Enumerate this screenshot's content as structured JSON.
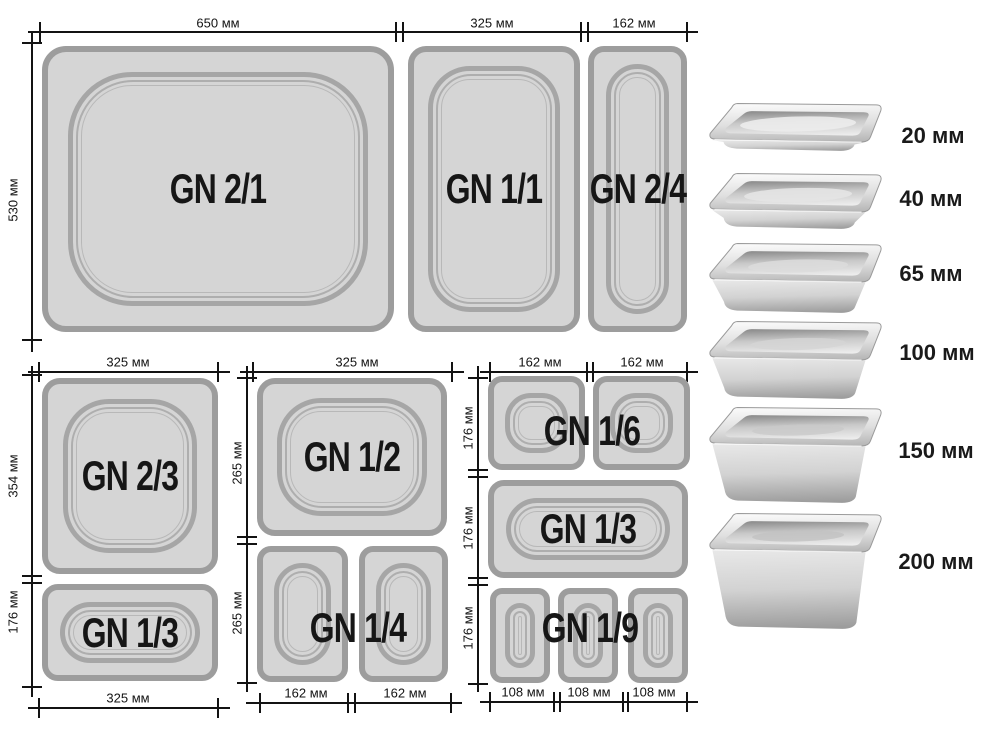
{
  "diagram": {
    "pans": {
      "gn21": "GN 2/1",
      "gn11": "GN 1/1",
      "gn24": "GN 2/4",
      "gn23": "GN 2/3",
      "gn13_left": "GN 1/3",
      "gn12": "GN 1/2",
      "gn14": "GN 1/4",
      "gn16": "GN 1/6",
      "gn13_right": "GN 1/3",
      "gn19": "GN 1/9"
    },
    "dims": {
      "d650": "650 мм",
      "d325_top": "325 мм",
      "d162_top": "162 мм",
      "d530": "530 мм",
      "bl_325_top": "325 мм",
      "bl_354": "354 мм",
      "bl_176": "176 мм",
      "bl_325_bottom": "325 мм",
      "mid_325_top": "325 мм",
      "mid_265_upper": "265 мм",
      "mid_265_lower": "265 мм",
      "mid_162_left": "162 мм",
      "mid_162_right": "162 мм",
      "r_162_left": "162 мм",
      "r_162_right": "162 мм",
      "r_176_upper": "176 мм",
      "r_176_middle": "176 мм",
      "r_176_lower": "176 мм",
      "r_108_left": "108 мм",
      "r_108_center": "108 мм",
      "r_108_right": "108 мм"
    },
    "depths": {
      "d20": "20 мм",
      "d40": "40 мм",
      "d65": "65 мм",
      "d100": "100 мм",
      "d150": "150 мм",
      "d200": "200 мм"
    },
    "colors": {
      "pan_fill": "#d5d5d5",
      "pan_border": "#9d9d9d",
      "dimension_line": "#131313",
      "label_text": "#161616"
    }
  }
}
